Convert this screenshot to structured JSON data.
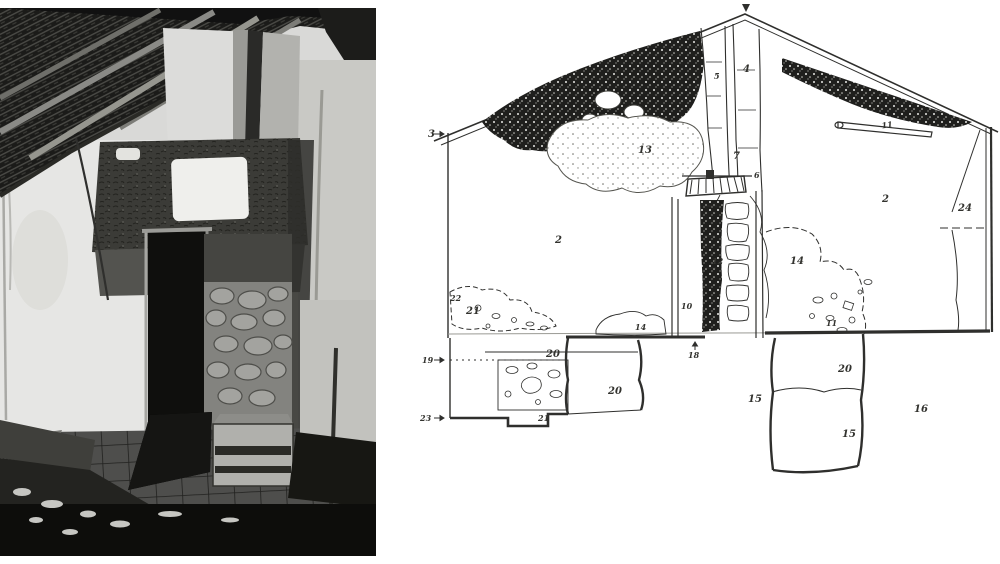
{
  "figure": {
    "type": "two-panel archaeological building-survey figure",
    "panels": [
      "interior-photograph",
      "annotated-wall-section-drawing"
    ]
  },
  "photo": {
    "content": "interior of ruined house: roof rafters, damaged plastered chimney wall, exposed stone pillar, dark doorway, wooden crate, tiled floor, rubble",
    "tones": {
      "dark": "#121210",
      "mud": "#3b3b39",
      "mid": "#8f8f8d",
      "plaster": "#e6e6e4",
      "paper": "#d9d9d7"
    }
  },
  "drawing": {
    "ink": "#2f2f2d",
    "paper": "#ffffff",
    "labels": [
      {
        "id": "eaves-level-3",
        "text": "3"
      },
      {
        "id": "crack-band-5",
        "text": "5"
      },
      {
        "id": "crack-band-4",
        "text": "4"
      },
      {
        "id": "plaster-patch-13",
        "text": "13"
      },
      {
        "id": "crack-band-7",
        "text": "7"
      },
      {
        "id": "crack-band-6",
        "text": "6"
      },
      {
        "id": "beam-11",
        "text": "11"
      },
      {
        "id": "wall-face-2-left",
        "text": "2"
      },
      {
        "id": "wall-face-2-right",
        "text": "2"
      },
      {
        "id": "corner-unit-24",
        "text": "24"
      },
      {
        "id": "door-infill-12",
        "text": "12"
      },
      {
        "id": "patch-14-right",
        "text": "14"
      },
      {
        "id": "rubble-22",
        "text": "22"
      },
      {
        "id": "rubble-21",
        "text": "21"
      },
      {
        "id": "jamb-10",
        "text": "10"
      },
      {
        "id": "patch-14-left",
        "text": "14"
      },
      {
        "id": "rubble-11",
        "text": "11"
      },
      {
        "id": "foundation-20-top",
        "text": "20"
      },
      {
        "id": "level-19",
        "text": "19"
      },
      {
        "id": "foundation-20-mid",
        "text": "20"
      },
      {
        "id": "foundation-21-bottom",
        "text": "21"
      },
      {
        "id": "level-23",
        "text": "23"
      },
      {
        "id": "sill-18",
        "text": "18"
      },
      {
        "id": "pit-15-centre",
        "text": "15"
      },
      {
        "id": "foundation-20-right",
        "text": "20"
      },
      {
        "id": "foundation-15-right",
        "text": "15"
      },
      {
        "id": "ground-16",
        "text": "16"
      }
    ]
  }
}
